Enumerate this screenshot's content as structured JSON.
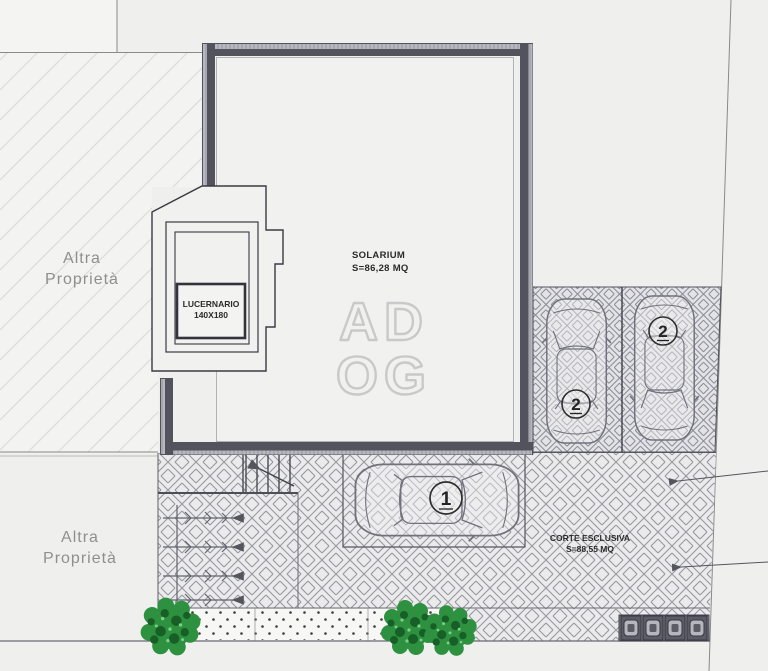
{
  "colors": {
    "background": "#efefee",
    "wall_dark": "#53535d",
    "wall_light_band": "#b7b7bf",
    "thin_line": "#5b5b63",
    "paving_line": "#94949c",
    "parcel_hatch_line": "#d9d9d6",
    "tree_green": "#2e9140",
    "tree_green_dark": "#175f26",
    "muted_label": "#8f8f8c",
    "text": "#2b2b2b",
    "watermark_gray": "#c9c9c9"
  },
  "labels": {
    "parcel_top": {
      "line1": "Altra",
      "line2": "Proprietà"
    },
    "parcel_bottom": {
      "line1": "Altra",
      "line2": "Proprietà"
    },
    "solarium": {
      "name": "SOLARIUM",
      "area": "S=86,28 MQ"
    },
    "lucernario": {
      "name": "LUCERNARIO",
      "size": "140X180"
    },
    "corte": {
      "name": "CORTE ESCLUSIVA",
      "area": "S=88,55 MQ"
    },
    "watermark": {
      "line1": "AD",
      "line2": "OG"
    }
  },
  "markers": {
    "parking_stall_left": "2",
    "parking_stall_right": "2",
    "driveway_car": "1"
  }
}
